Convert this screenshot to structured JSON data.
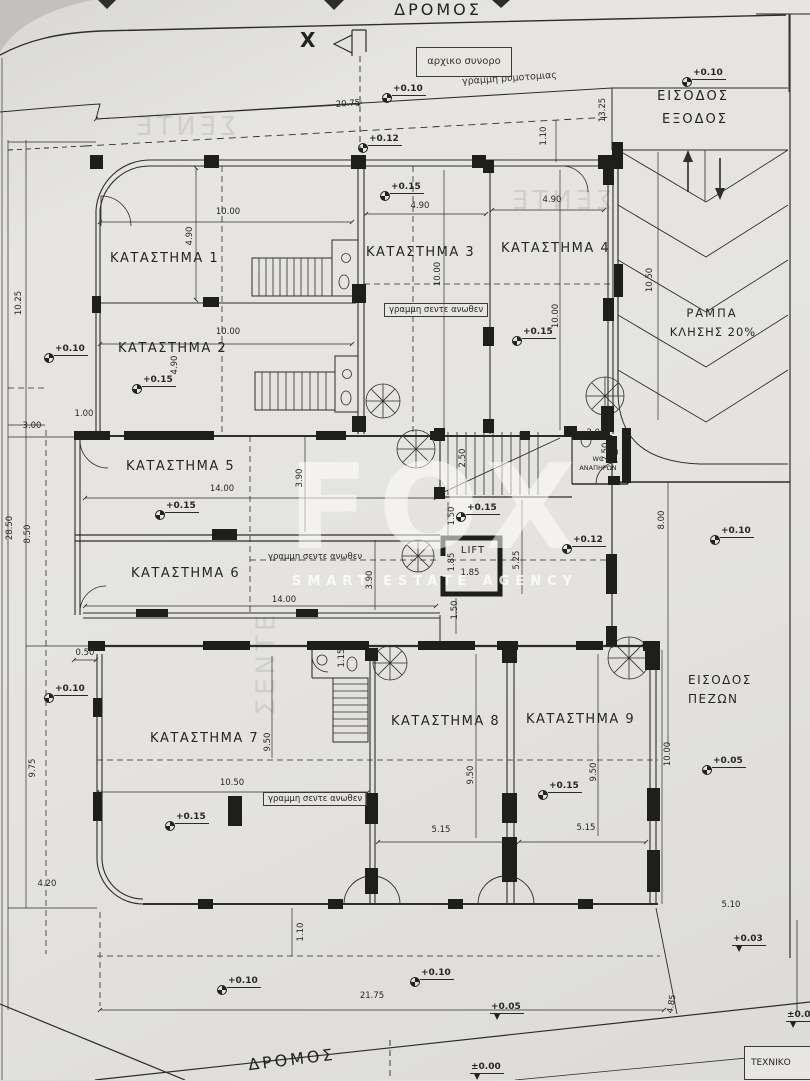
{
  "texts": {
    "road_top": "ΔΡΟΜΟΣ",
    "road_bottom": "ΔΡΟΜΟΣ",
    "original_boundary": "αρχικο συνορο",
    "street_line": "γραμμη ρυμοτομιας",
    "entry": "ΕΙΣΟΔΟΣ",
    "exit": "ΕΞΟΔΟΣ",
    "ramp1": "ΡΑΜΠΑ",
    "ramp2": "ΚΛΗΣΗΣ 20%",
    "ped1": "ΕΙΣΟΔΟΣ",
    "ped2": "ΠΕΖΩΝ",
    "lift": "LIFT",
    "wc1": "WC",
    "wc2": "ΑΝΑΠΗΡΩΝ",
    "canopy": "γραμμη σεντε ανωθεν",
    "tech": "ΤΕΧΝΙΚΟ",
    "section_mark": "X",
    "watermark_main": "FOX",
    "watermark_sub": "SMART ESTATE AGENCY"
  },
  "colors": {
    "paper": "#e4e3df",
    "ink": "#2d2d2c",
    "watermark": "#ffffff"
  },
  "shops": [
    {
      "label": "ΚΑΤΑΣΤΗΜΑ 1",
      "x": 110,
      "y": 251
    },
    {
      "label": "ΚΑΤΑΣΤΗΜΑ 2",
      "x": 118,
      "y": 341
    },
    {
      "label": "ΚΑΤΑΣΤΗΜΑ 3",
      "x": 366,
      "y": 245
    },
    {
      "label": "ΚΑΤΑΣΤΗΜΑ 4",
      "x": 501,
      "y": 241
    },
    {
      "label": "ΚΑΤΑΣΤΗΜΑ 5",
      "x": 126,
      "y": 459
    },
    {
      "label": "ΚΑΤΑΣΤΗΜΑ 6",
      "x": 131,
      "y": 566
    },
    {
      "label": "ΚΑΤΑΣΤΗΜΑ 7",
      "x": 150,
      "y": 731
    },
    {
      "label": "ΚΑΤΑΣΤΗΜΑ 8",
      "x": 391,
      "y": 714
    },
    {
      "label": "ΚΑΤΑΣΤΗΜΑ 9",
      "x": 526,
      "y": 712
    }
  ],
  "dims": [
    {
      "t": "20.75",
      "x": 348,
      "y": 104,
      "r": -4
    },
    {
      "t": "13.25",
      "x": 603,
      "y": 110,
      "r": -90
    },
    {
      "t": "1.10",
      "x": 544,
      "y": 136,
      "r": -90
    },
    {
      "t": "10.00",
      "x": 228,
      "y": 212
    },
    {
      "t": "4.90",
      "x": 190,
      "y": 236,
      "r": -90
    },
    {
      "t": "4.90",
      "x": 420,
      "y": 206
    },
    {
      "t": "4.90",
      "x": 552,
      "y": 200
    },
    {
      "t": "10.00",
      "x": 438,
      "y": 274,
      "r": -90
    },
    {
      "t": "10.00",
      "x": 556,
      "y": 316,
      "r": -90
    },
    {
      "t": "10.50",
      "x": 650,
      "y": 280,
      "r": -90
    },
    {
      "t": "10.00",
      "x": 228,
      "y": 332
    },
    {
      "t": "4.90",
      "x": 175,
      "y": 365,
      "r": -90
    },
    {
      "t": "1.00",
      "x": 84,
      "y": 414
    },
    {
      "t": "3.00",
      "x": 32,
      "y": 426
    },
    {
      "t": "10.25",
      "x": 19,
      "y": 303,
      "r": -90
    },
    {
      "t": "28.50",
      "x": 10,
      "y": 528,
      "r": -90
    },
    {
      "t": "8.50",
      "x": 28,
      "y": 534,
      "r": -90
    },
    {
      "t": "14.00",
      "x": 222,
      "y": 489
    },
    {
      "t": "3.90",
      "x": 300,
      "y": 478,
      "r": -90
    },
    {
      "t": "2.50",
      "x": 463,
      "y": 458,
      "r": -90
    },
    {
      "t": "2.05",
      "x": 596,
      "y": 433
    },
    {
      "t": "2.50",
      "x": 606,
      "y": 452,
      "r": -90
    },
    {
      "t": "1.50",
      "x": 452,
      "y": 516,
      "r": -90
    },
    {
      "t": "1.85",
      "x": 452,
      "y": 562,
      "r": -90
    },
    {
      "t": "1.85",
      "x": 470,
      "y": 573
    },
    {
      "t": "5.25",
      "x": 517,
      "y": 560,
      "r": -90
    },
    {
      "t": "1.50",
      "x": 455,
      "y": 610,
      "r": -90
    },
    {
      "t": "8.00",
      "x": 662,
      "y": 520,
      "r": -90
    },
    {
      "t": "14.00",
      "x": 284,
      "y": 600
    },
    {
      "t": "3.90",
      "x": 370,
      "y": 580,
      "r": -90
    },
    {
      "t": "0.50",
      "x": 85,
      "y": 653
    },
    {
      "t": "9.75",
      "x": 33,
      "y": 768,
      "r": -90
    },
    {
      "t": "9.50",
      "x": 268,
      "y": 742,
      "r": -90
    },
    {
      "t": "1.15",
      "x": 342,
      "y": 658,
      "r": -90
    },
    {
      "t": "10.50",
      "x": 232,
      "y": 783
    },
    {
      "t": "9.50",
      "x": 471,
      "y": 775,
      "r": -90
    },
    {
      "t": "9.50",
      "x": 594,
      "y": 772,
      "r": -90
    },
    {
      "t": "5.15",
      "x": 441,
      "y": 830
    },
    {
      "t": "5.15",
      "x": 586,
      "y": 828
    },
    {
      "t": "10.00",
      "x": 668,
      "y": 754,
      "r": -90
    },
    {
      "t": "4.20",
      "x": 47,
      "y": 884
    },
    {
      "t": "5.10",
      "x": 731,
      "y": 905
    },
    {
      "t": "1.10",
      "x": 301,
      "y": 932,
      "r": -90
    },
    {
      "t": "21.75",
      "x": 372,
      "y": 996
    },
    {
      "t": "4.85",
      "x": 672,
      "y": 1004,
      "r": -80
    }
  ],
  "levels": [
    {
      "t": "+0.10",
      "x": 392,
      "y": 84
    },
    {
      "t": "+0.12",
      "x": 368,
      "y": 134
    },
    {
      "t": "+0.10",
      "x": 692,
      "y": 68
    },
    {
      "t": "+0.15",
      "x": 390,
      "y": 182
    },
    {
      "t": "+0.15",
      "x": 142,
      "y": 375
    },
    {
      "t": "+0.10",
      "x": 54,
      "y": 344
    },
    {
      "t": "+0.15",
      "x": 522,
      "y": 327
    },
    {
      "t": "+0.15",
      "x": 165,
      "y": 501
    },
    {
      "t": "+0.15",
      "x": 466,
      "y": 503
    },
    {
      "t": "+0.12",
      "x": 572,
      "y": 535
    },
    {
      "t": "+0.10",
      "x": 720,
      "y": 526
    },
    {
      "t": "+0.10",
      "x": 54,
      "y": 684
    },
    {
      "t": "+0.15",
      "x": 175,
      "y": 812
    },
    {
      "t": "+0.15",
      "x": 548,
      "y": 781
    },
    {
      "t": "+0.05",
      "x": 712,
      "y": 756
    },
    {
      "t": "+0.10",
      "x": 227,
      "y": 976
    },
    {
      "t": "+0.10",
      "x": 420,
      "y": 968
    },
    {
      "t": "+0.03",
      "x": 732,
      "y": 934,
      "s": "tri"
    },
    {
      "t": "+0.05",
      "x": 490,
      "y": 1002,
      "s": "tri"
    },
    {
      "t": "±0.00",
      "x": 470,
      "y": 1062,
      "s": "tri"
    },
    {
      "t": "±0.0",
      "x": 786,
      "y": 1010,
      "s": "tri"
    }
  ],
  "ghosts": [
    {
      "t": "ΣΕΝΤΕ",
      "x": 508,
      "y": 186,
      "m": 1
    },
    {
      "t": "ΣΕΝΤΕ",
      "x": 214,
      "y": 648,
      "r": -90
    },
    {
      "t": "ΣΕΝΤΕ",
      "x": 132,
      "y": 112,
      "m": 1
    }
  ]
}
